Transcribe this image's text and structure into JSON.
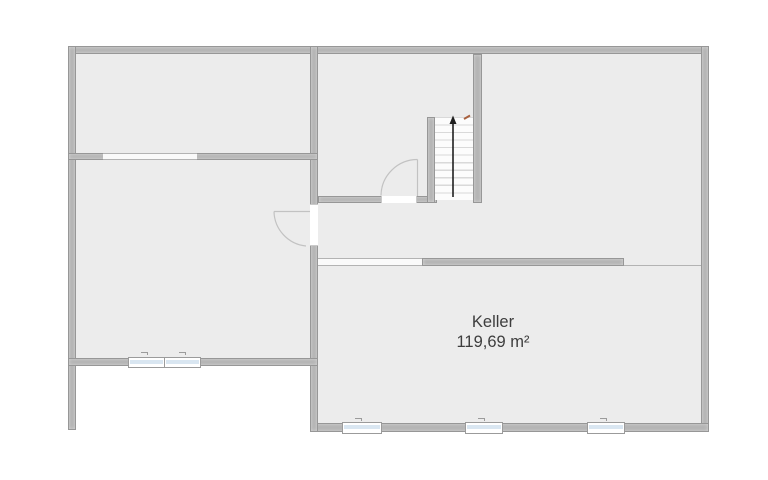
{
  "room": {
    "name": "Keller",
    "area": "119,69 m²"
  },
  "stairs": {
    "direction_icon": "up-arrow",
    "tread_count": 11
  },
  "elements": {
    "window_count": 5,
    "door_count": 2,
    "wall_passage_count": 2
  },
  "colors": {
    "background": "#ffffff",
    "floor": "#ececec",
    "wall_fill": "#b5b5b5",
    "wall_outline": "#979797",
    "window_glass": "#d9e6f1",
    "window_frame": "#9b9b9b",
    "door_arc": "#c2c2c2",
    "stair_tread_line": "#d9d9d9",
    "stair_arrow": "#1f1f1f",
    "stair_entry_marker": "#a8603e",
    "room_divider_line": "#b3b3b3",
    "label_text": "#3d3d3d"
  }
}
